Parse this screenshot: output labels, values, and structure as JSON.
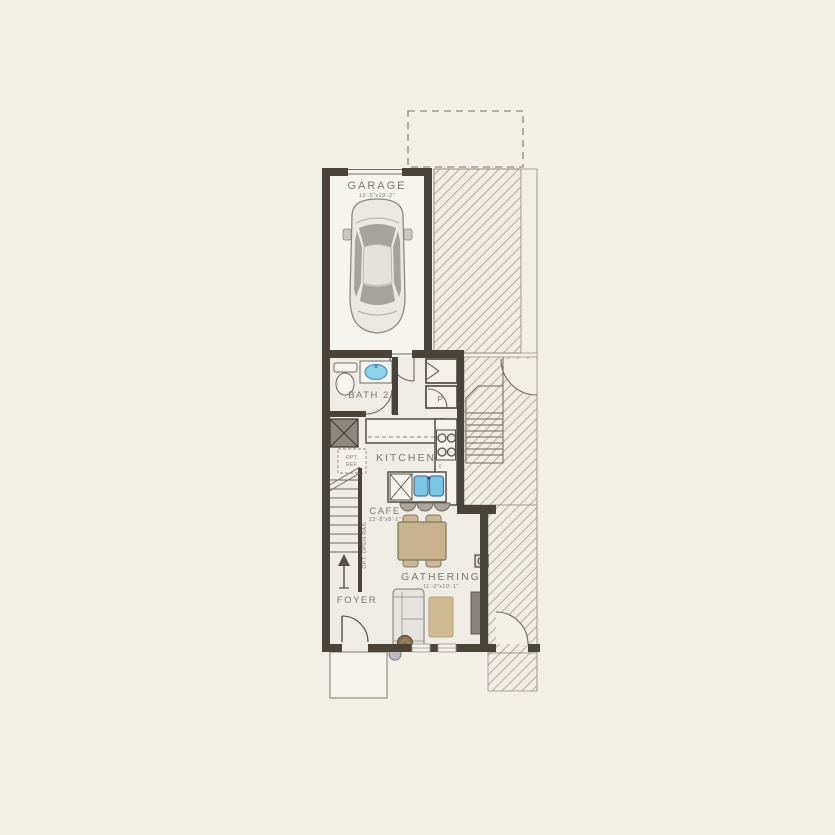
{
  "plan": {
    "title": "First Floor Plan",
    "rooms": {
      "garage": {
        "label": "GARAGE",
        "dims": "10'-5\"x19'-2\""
      },
      "bath2": {
        "label": "BATH 2"
      },
      "kitchen": {
        "label": "KITCHEN"
      },
      "pantry": {
        "label": "P"
      },
      "cafe": {
        "label": "CAFE",
        "dims": "13'-8\"x8'-1\""
      },
      "gathering": {
        "label": "GATHERING",
        "dims": "11'-0\"x19'-1\""
      },
      "foyer": {
        "label": "FOYER"
      }
    },
    "annotations": {
      "opt_ref_line1": "OPT.",
      "opt_ref_line2": "REF.",
      "opt_open_rail": "OPT. OPEN RAIL"
    },
    "colors": {
      "background": "#f2efe7",
      "wall": "#49433a",
      "interior_floor": "#efece6",
      "garage_floor": "#f6f4ee",
      "hatch_line": "#b7b1a5",
      "fixture_blue": "#7cc3e6",
      "furniture_tan": "#c7b28c",
      "label_text": "#7c7770"
    }
  }
}
